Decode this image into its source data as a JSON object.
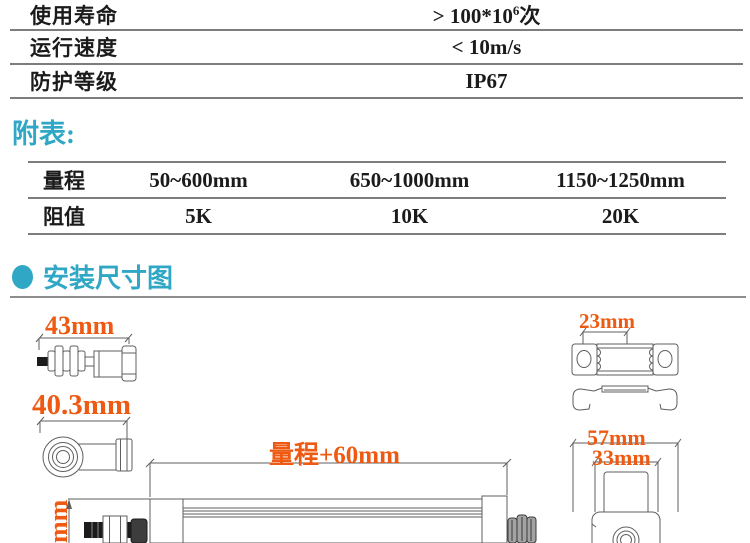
{
  "colors": {
    "accent_teal": "#2fa7c5",
    "dimension_orange": "#ee5a12",
    "table_line_gray": "#7d7d7d",
    "text_dark": "#1b1b1b"
  },
  "spec_table": {
    "rows": [
      {
        "label": "使用寿命",
        "value_prefix": "> 100*10",
        "value_sup": "6",
        "value_suffix": "次"
      },
      {
        "label": "运行速度",
        "value": "< 10m/s"
      },
      {
        "label": "防护等级",
        "value": "IP67"
      }
    ]
  },
  "appendix": {
    "heading": "附表:",
    "table": {
      "rows": [
        {
          "label": "量程",
          "values": [
            "50~600mm",
            "650~1000mm",
            "1150~1250mm"
          ]
        },
        {
          "label": "阻值",
          "values": [
            "5K",
            "10K",
            "20K"
          ]
        }
      ]
    }
  },
  "installation": {
    "heading": "安装尺寸图",
    "dim_rod_tip": "43mm",
    "dim_rod_end": "40.3mm",
    "dim_stroke": "量程+60mm",
    "dim_clamp": "23mm",
    "dim_end_outer": "57mm",
    "dim_end_inner": "33mm",
    "dim_body_height_partial": "mm"
  }
}
